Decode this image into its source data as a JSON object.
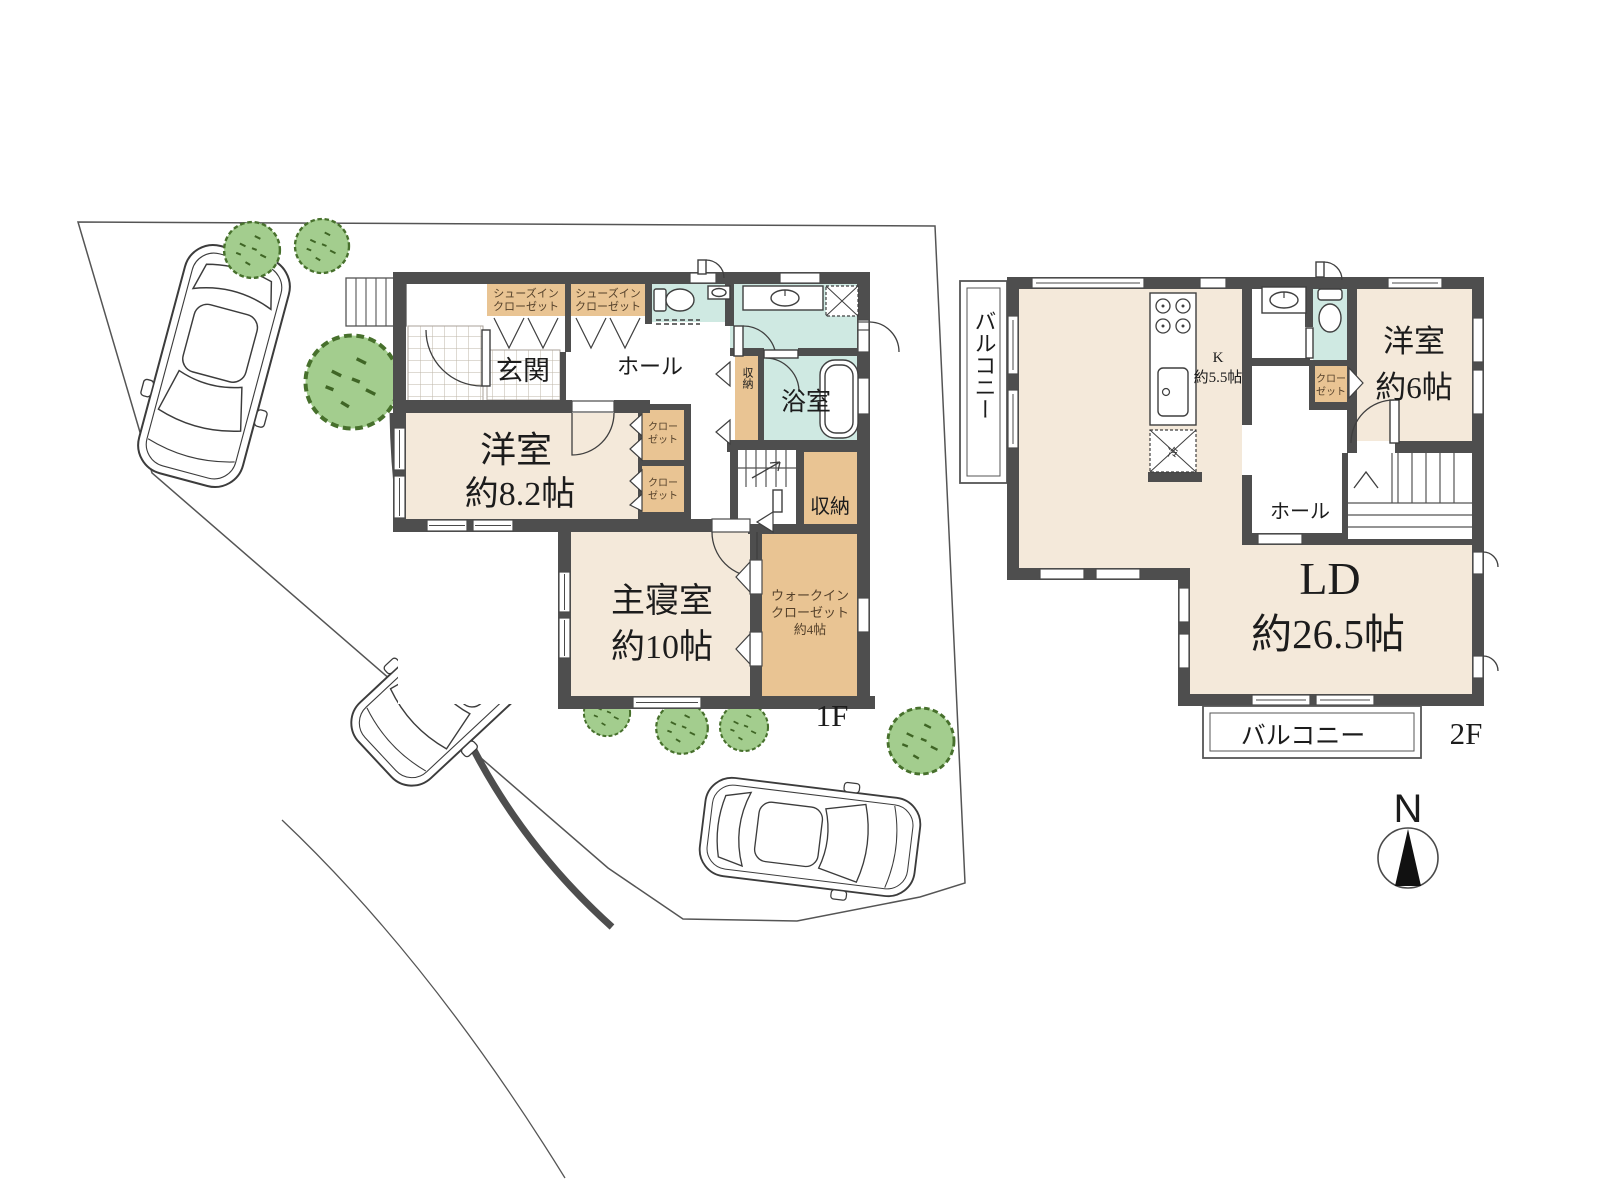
{
  "palette": {
    "wall": "#4e4e4e",
    "room_beige": "#f4e9da",
    "closet_tan": "#e9c493",
    "bath_teal": "#cfe9e2",
    "tree_green": "#a3cd8e",
    "tree_edge": "#47702c",
    "line": "#3f3f3f"
  },
  "floor1": {
    "tag": "1F",
    "entrance": "玄関",
    "hall": "ホール",
    "western_room": {
      "name": "洋室",
      "size": "約8.2帖"
    },
    "master_bedroom": {
      "name": "主寝室",
      "size": "約10帖"
    },
    "bathroom": "浴室",
    "storage": "収納",
    "side_storage": "収納",
    "shoes_closet": {
      "line1": "シューズイン",
      "line2": "クローゼット"
    },
    "closet": {
      "line1": "クロー",
      "line2": "ゼット"
    },
    "walk_in_closet": {
      "line1": "ウォークイン",
      "line2": "クローゼット",
      "size": "約4帖"
    }
  },
  "floor2": {
    "tag": "2F",
    "balcony_left": "バルコニー",
    "balcony_bottom": "バルコニー",
    "kitchen": {
      "name": "K",
      "size": "約5.5帖"
    },
    "fridge_mark": "冷",
    "western_room": {
      "name": "洋室",
      "size": "約6帖"
    },
    "closet": {
      "line1": "クロー",
      "line2": "ゼット"
    },
    "hall": "ホール",
    "living_dining": {
      "name": "LD",
      "size": "約26.5帖"
    }
  },
  "compass": {
    "north": "N"
  }
}
